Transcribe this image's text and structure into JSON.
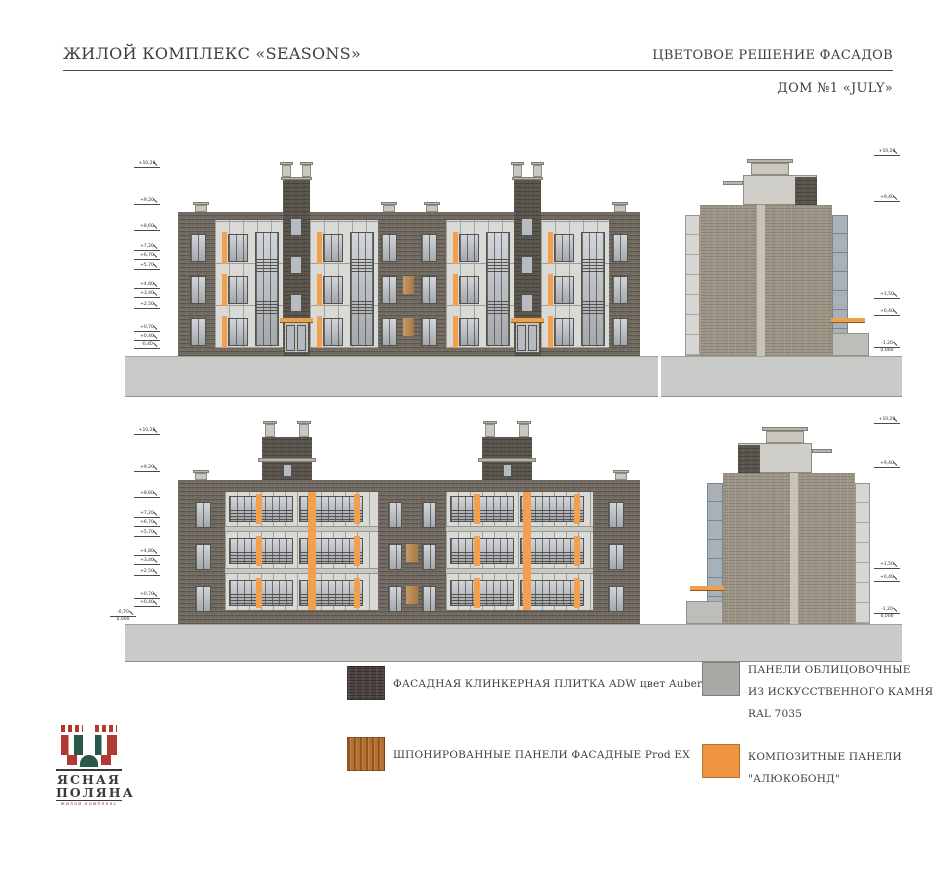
{
  "header": {
    "project_title": "ЖИЛОЙ КОМПЛЕКС «SEASONS»",
    "sheet_title": "ЦВЕТОВОЕ РЕШЕНИЕ ФАСАДОВ",
    "house_subtitle": "ДОМ №1 «JULY»"
  },
  "logo": {
    "name_line1": "ЯСНАЯ",
    "name_line2": "ПОЛЯНА",
    "caption": "жилой комплекс",
    "brand_red": "#b03a31",
    "brand_green": "#27584a"
  },
  "legend": {
    "items": [
      {
        "material": "clinker-tile",
        "swatch_color": "#4e4441",
        "lines": [
          "ФАСАДНАЯ  КЛИНКЕРНАЯ ПЛИТКА ADW цвет Aubergine"
        ]
      },
      {
        "material": "veneered-panels",
        "swatch_color": "#b4702f",
        "lines": [
          "ШПОНИРОВАННЫЕ ПАНЕЛИ  ФАСАДНЫЕ Prod EX"
        ]
      },
      {
        "material": "artificial-stone-panels",
        "swatch_color": "#a9aaa5",
        "lines": [
          "ПАНЕЛИ ОБЛИЦОВОЧНЫЕ",
          "ИЗ ИСКУССТВЕННОГО КАМНЯ",
          "RAL  7035"
        ]
      },
      {
        "material": "composite-panels",
        "swatch_color": "#f0953f",
        "lines": [
          "КОМПОЗИТНЫЕ ПАНЕЛИ",
          "\"АЛЮКОБОНД\""
        ]
      }
    ]
  },
  "markers": {
    "front_left": [
      {
        "label": "+10,20",
        "y": 167
      },
      {
        "label": "+9,20",
        "y": 204
      },
      {
        "label": "+8,60",
        "y": 230
      },
      {
        "label": "+7,20",
        "y": 250
      },
      {
        "label": "+6,70",
        "y": 259
      },
      {
        "label": "+5,70",
        "y": 269
      },
      {
        "label": "+4,80",
        "y": 288
      },
      {
        "label": "+3,40",
        "y": 297
      },
      {
        "label": "+2,50",
        "y": 308
      },
      {
        "label": "+0,70",
        "y": 331
      },
      {
        "label": "+0,40",
        "y": 340
      },
      {
        "label": "-0,40",
        "y": 348
      }
    ],
    "front_right": [
      {
        "label": "+10,20",
        "y": 155
      },
      {
        "label": "+9,40",
        "y": 201
      },
      {
        "label": "+1,50",
        "y": 298
      },
      {
        "label": "+0,40",
        "y": 315
      },
      {
        "label": "-1,20",
        "label2": "0,000",
        "y": 347
      }
    ],
    "rear_left": [
      {
        "label": "+10,20",
        "y": 434
      },
      {
        "label": "+9,20",
        "y": 471
      },
      {
        "label": "+8,60",
        "y": 497
      },
      {
        "label": "+7,20",
        "y": 517
      },
      {
        "label": "+6,70",
        "y": 526
      },
      {
        "label": "+5,70",
        "y": 536
      },
      {
        "label": "+4,80",
        "y": 555
      },
      {
        "label": "+3,40",
        "y": 564
      },
      {
        "label": "+2,50",
        "y": 575
      },
      {
        "label": "+0,70",
        "y": 598
      },
      {
        "label": "+0,40",
        "y": 606
      }
    ],
    "rear_corner": [
      {
        "label": "-0,70",
        "label2": "0,000",
        "y": 616,
        "x": 110
      }
    ],
    "rear_right": [
      {
        "label": "+10,20",
        "y": 423
      },
      {
        "label": "+9,40",
        "y": 467
      },
      {
        "label": "+1,50",
        "y": 568
      },
      {
        "label": "+0,40",
        "y": 581
      },
      {
        "label": "-1,20",
        "label2": "0,000",
        "y": 613
      }
    ]
  },
  "colors": {
    "facade_brick": "#6f6960",
    "side_brick": "#9e9788",
    "stone_panel": "#d9d9d5",
    "accent_orange": "#f2a04d",
    "ground": "#cacac8"
  }
}
